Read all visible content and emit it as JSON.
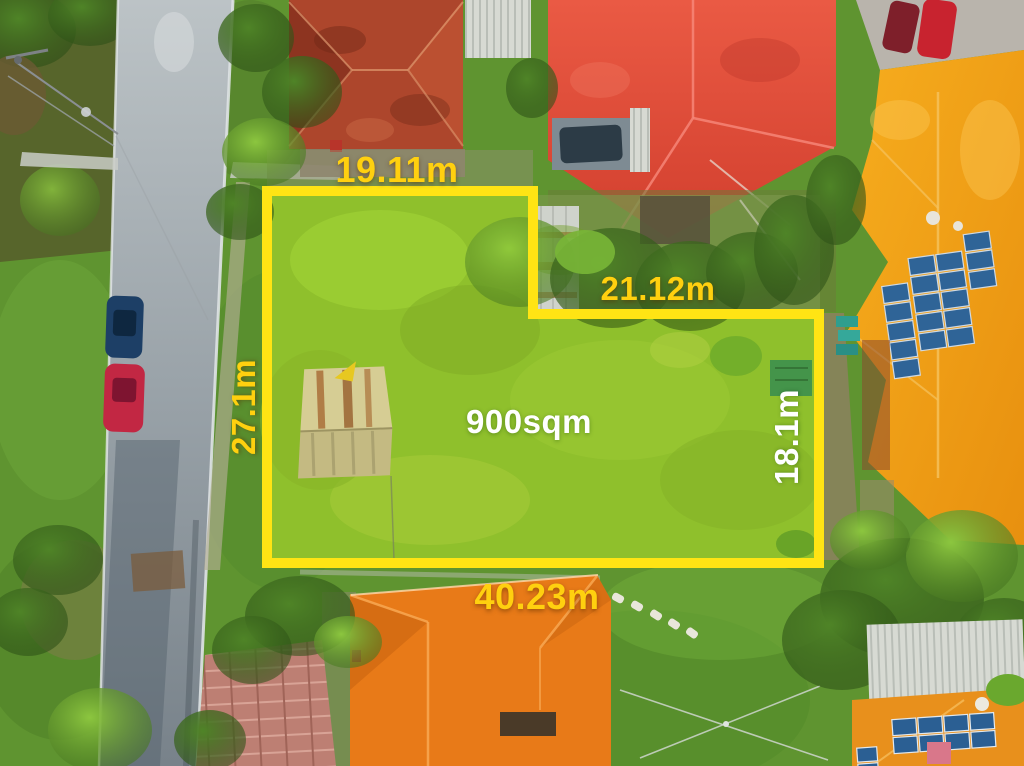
{
  "photo": {
    "area_label": "900sqm",
    "dimensions": {
      "top": "19.11m",
      "inner_top": "21.12m",
      "left": "27.1m",
      "right": "18.1m",
      "bottom": "40.23m"
    },
    "colors": {
      "boundary": "#ffe414",
      "label_yellow": "#ffd00f",
      "label_white": "#ffffff"
    }
  }
}
